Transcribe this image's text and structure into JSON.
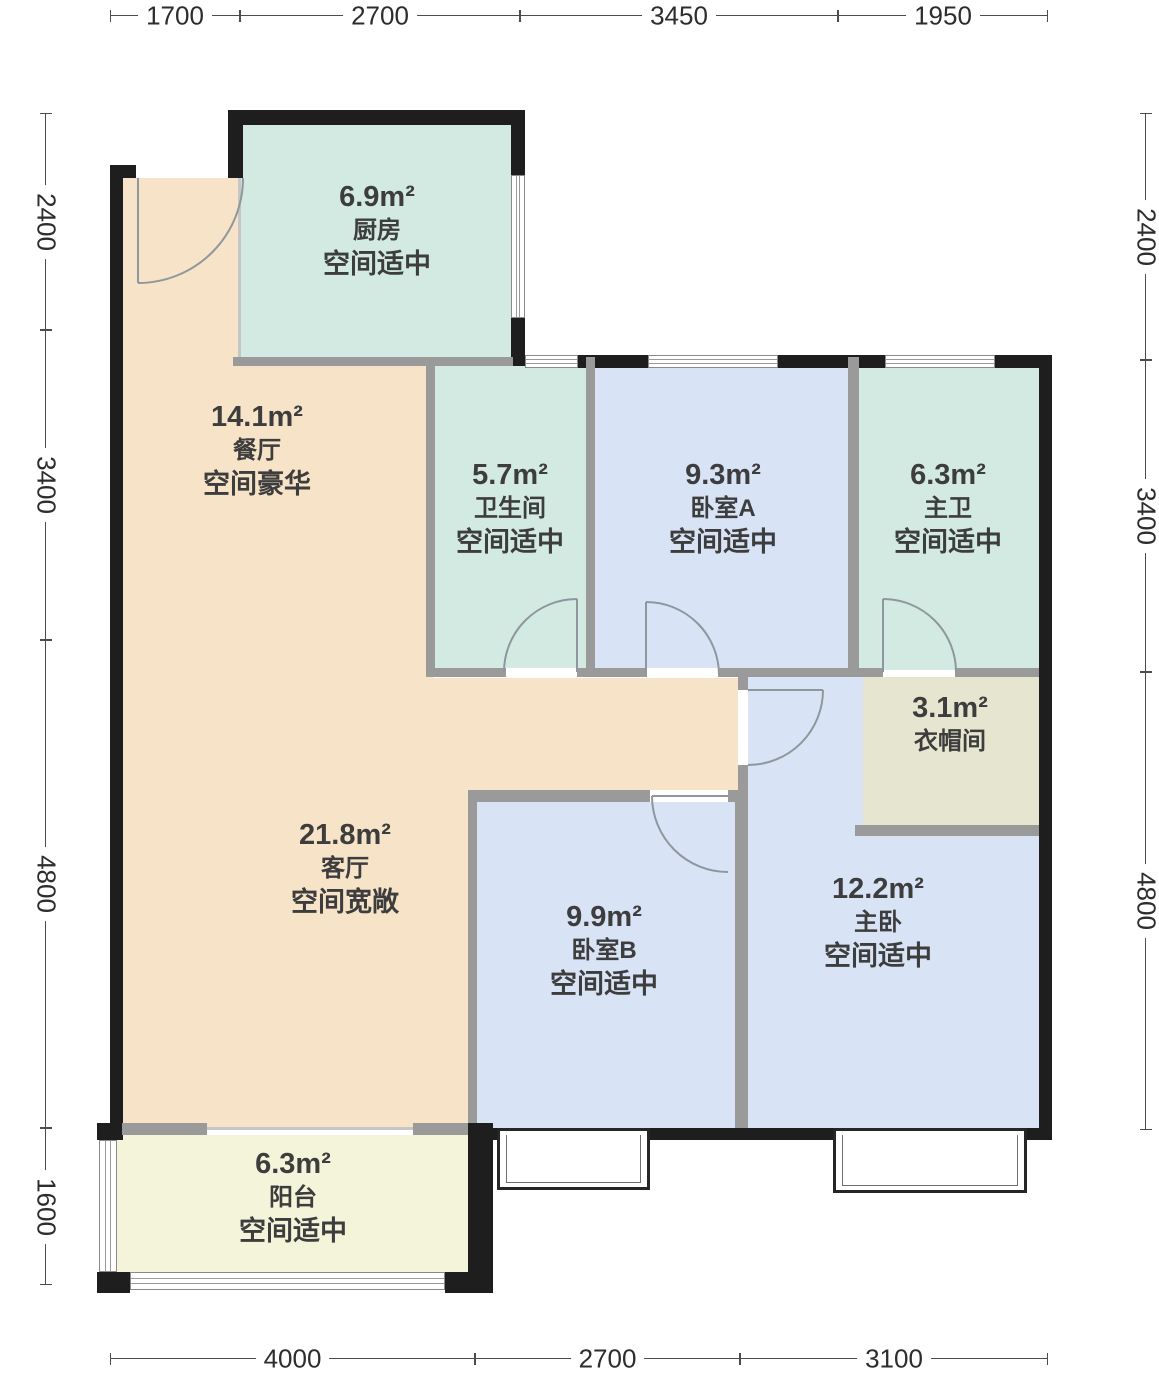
{
  "rooms": {
    "kitchen": {
      "area": "6.9m²",
      "name": "厨房",
      "note": "空间适中"
    },
    "dining": {
      "area": "14.1m²",
      "name": "餐厅",
      "note": "空间豪华"
    },
    "bathroom": {
      "area": "5.7m²",
      "name": "卫生间",
      "note": "空间适中"
    },
    "bedroom_a": {
      "area": "9.3m²",
      "name": "卧室A",
      "note": "空间适中"
    },
    "master_bath": {
      "area": "6.3m²",
      "name": "主卫",
      "note": "空间适中"
    },
    "cloakroom": {
      "area": "3.1m²",
      "name": "衣帽间"
    },
    "living": {
      "area": "21.8m²",
      "name": "客厅",
      "note": "空间宽敞"
    },
    "bedroom_b": {
      "area": "9.9m²",
      "name": "卧室B",
      "note": "空间适中"
    },
    "master_bedroom": {
      "area": "12.2m²",
      "name": "主卧",
      "note": "空间适中"
    },
    "balcony": {
      "area": "6.3m²",
      "name": "阳台",
      "note": "空间适中"
    }
  },
  "dimensions": {
    "top": [
      "1700",
      "2700",
      "3450",
      "1950"
    ],
    "bottom": [
      "4000",
      "2700",
      "3100"
    ],
    "left": [
      "2400",
      "3400",
      "4800",
      "1600"
    ],
    "right": [
      "2400",
      "3400",
      "4800"
    ]
  },
  "colors": {
    "floor_peach": "#f6e3c8",
    "floor_mint": "#d2eae2",
    "floor_blue": "#d8e3f6",
    "floor_beige": "#e6e6d0",
    "floor_cream": "#f3f4da",
    "wall_exterior": "#1e1e1e",
    "wall_interior": "#9a9a9a",
    "text": "#3d3d3d"
  }
}
